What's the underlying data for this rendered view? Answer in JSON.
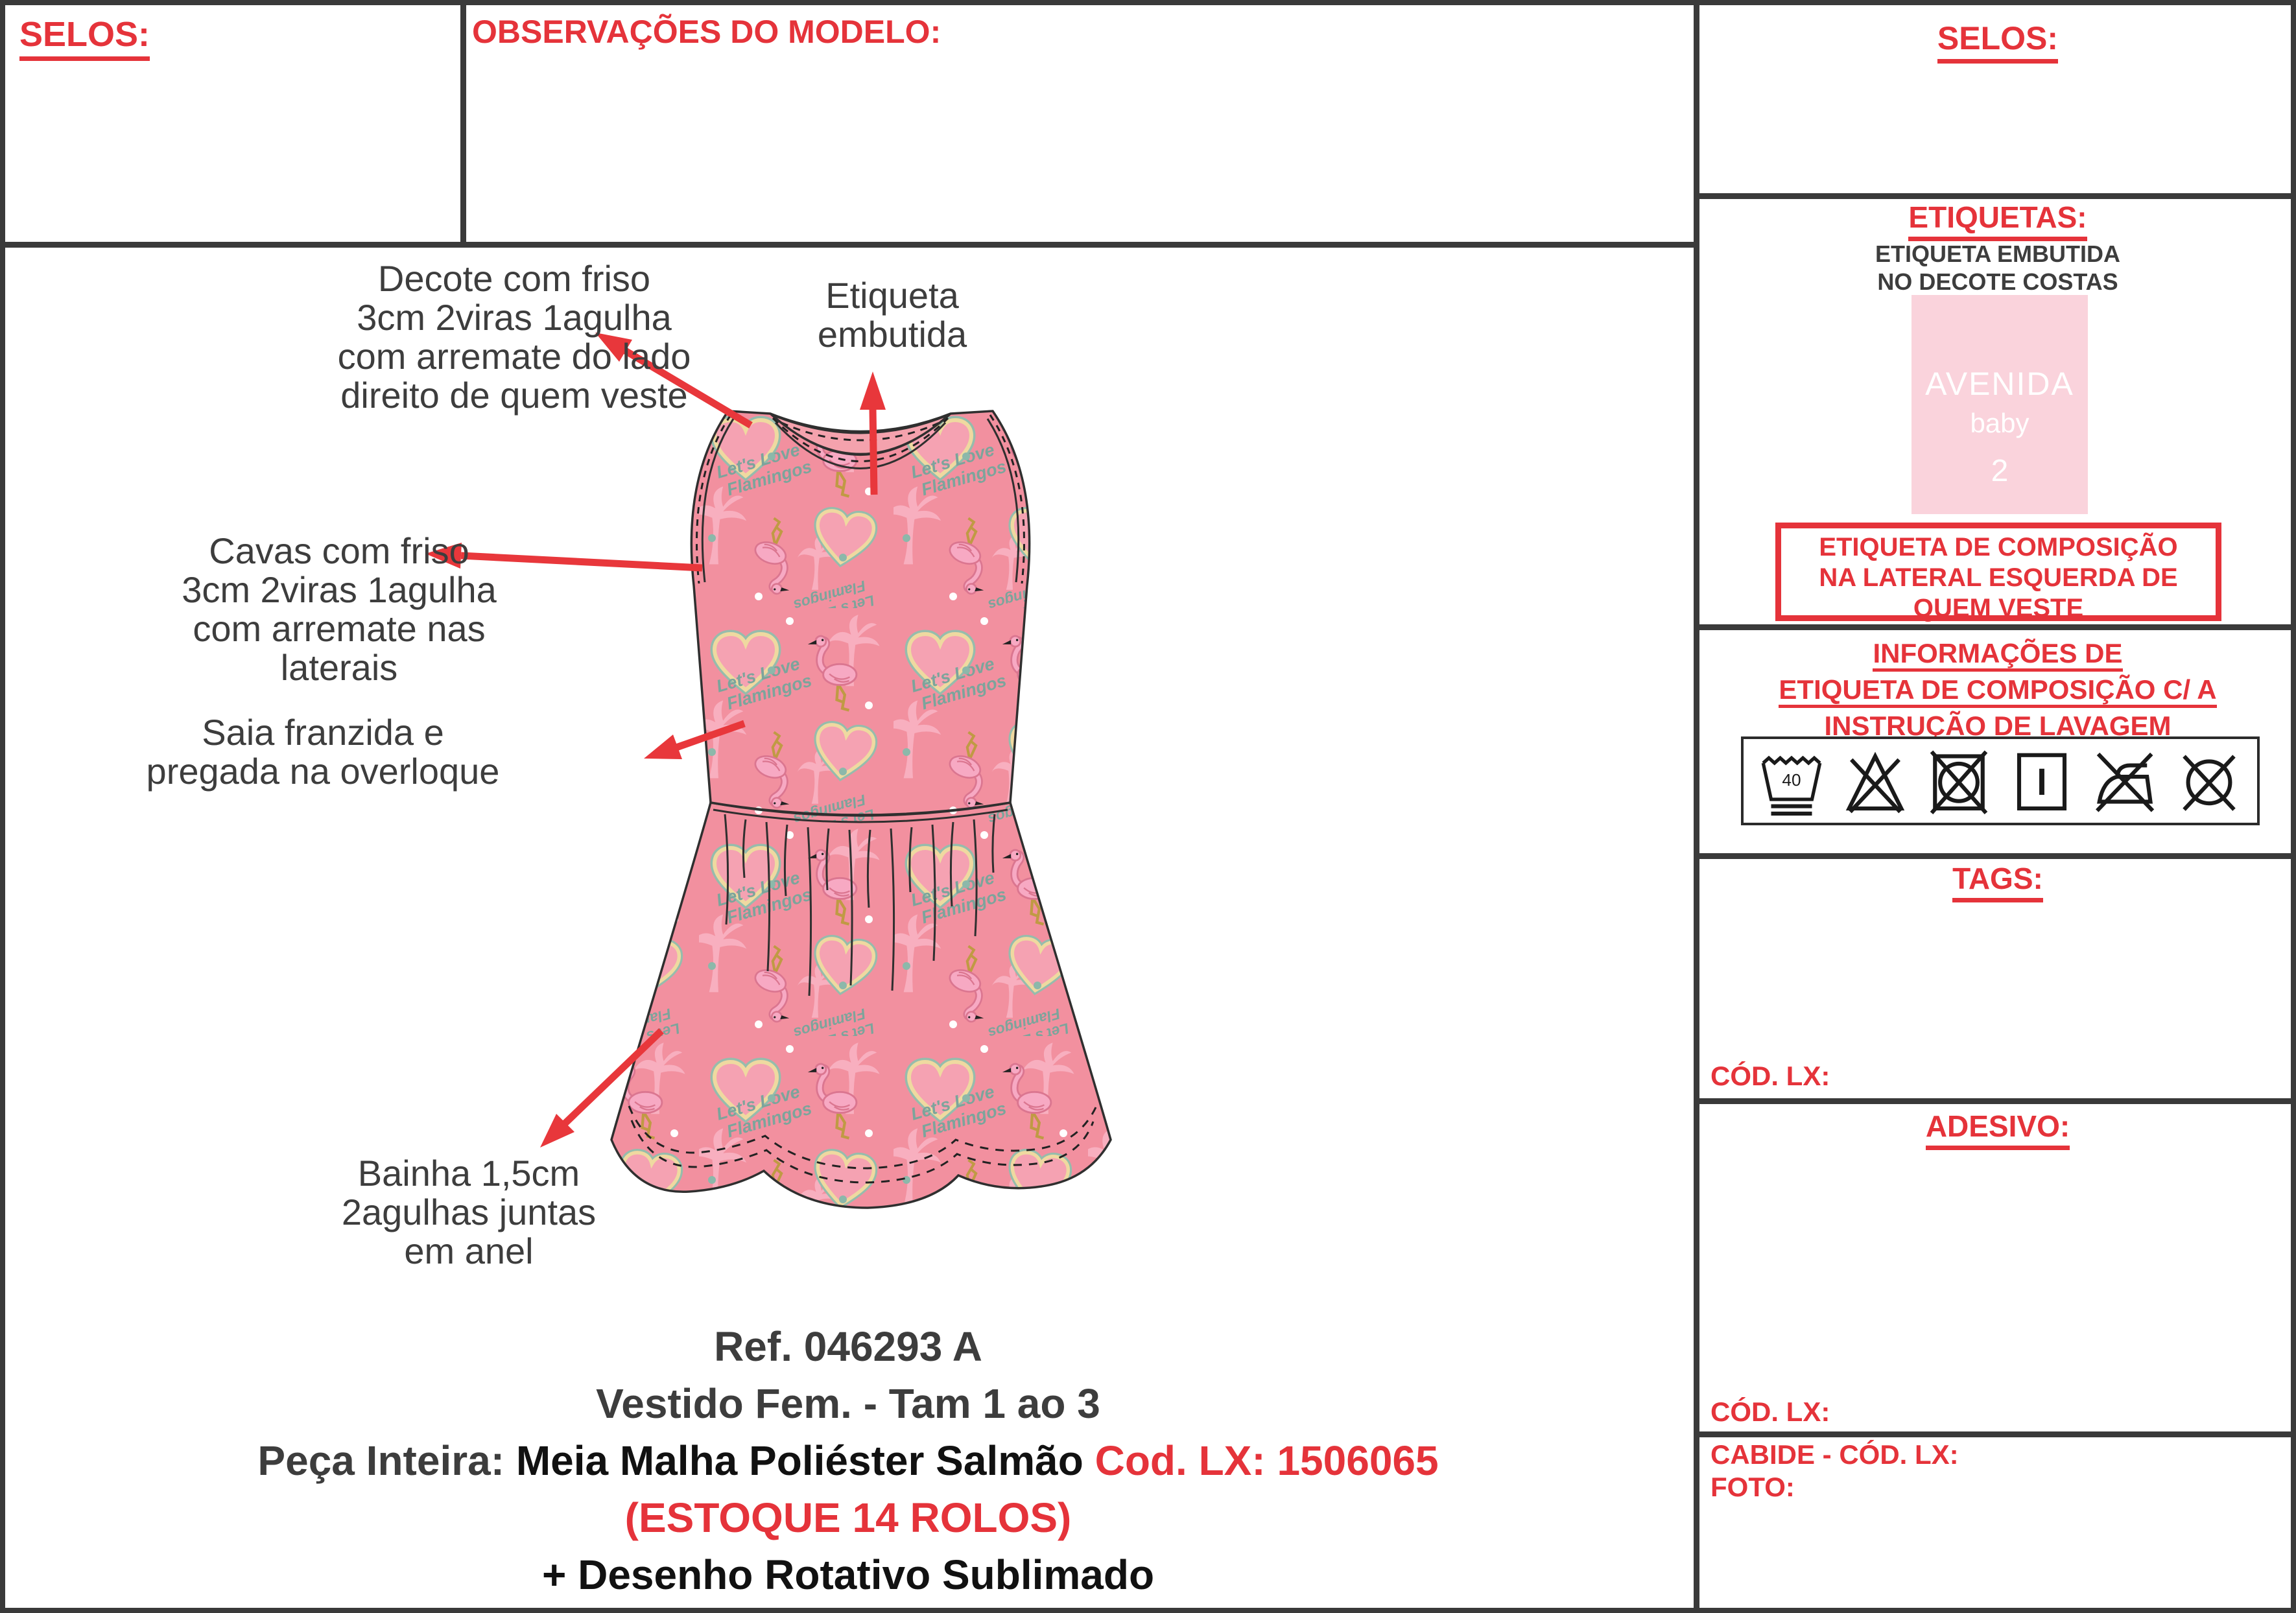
{
  "colors": {
    "accent_red": "#e5333a",
    "text_dark": "#3d3d3d",
    "text_black": "#111111",
    "border": "#3a3a3a",
    "dress_base": "#f2909f",
    "swatch_pink": "#fad3dc"
  },
  "top": {
    "selos_title": "SELOS:",
    "observations_title": "OBSERVAÇÕES DO MODELO:"
  },
  "annotations": {
    "decote": {
      "lines": [
        "Decote com friso",
        "3cm 2viras 1agulha",
        "com arremate do lado",
        "direito de quem veste"
      ]
    },
    "etiqueta": {
      "lines": [
        "Etiqueta",
        "embutida"
      ]
    },
    "cavas": {
      "lines": [
        "Cavas com friso",
        "3cm 2viras 1agulha",
        "com arremate nas",
        "laterais"
      ]
    },
    "saia": {
      "lines": [
        "Saia franzida e",
        "pregada na overloque"
      ]
    },
    "bainha": {
      "lines": [
        "Bainha 1,5cm",
        "2agulhas juntas",
        "em anel"
      ]
    }
  },
  "pattern": {
    "script_line1": "Let's Love",
    "script_line2": "Flamingos"
  },
  "product": {
    "ref": "Ref. 046293 A",
    "name_size": "Vestido Fem.  - Tam 1 ao 3",
    "fabric_label": "Peça Inteira: ",
    "fabric": "Meia Malha Poliéster Salmão ",
    "fabric_code": "Cod. LX: 1506065",
    "stock": "(ESTOQUE 14 ROLOS)",
    "print": "+ Desenho Rotativo Sublimado"
  },
  "right": {
    "selos_title": "SELOS:",
    "etiquetas": {
      "title": "ETIQUETAS:",
      "note_line1": "ETIQUETA EMBUTIDA",
      "note_line2": "NO DECOTE COSTAS",
      "label_swatch": {
        "brand": "AVENIDA",
        "sub": "baby",
        "size": "2"
      },
      "warning_lines": [
        "ETIQUETA DE COMPOSIÇÃO",
        "NA LATERAL ESQUERDA DE",
        "QUEM VESTE"
      ]
    },
    "care": {
      "title_lines": [
        "INFORMAÇÕES DE",
        "ETIQUETA DE COMPOSIÇÃO C/ A",
        "INSTRUÇÃO DE LAVAGEM"
      ],
      "wash_temp": "40",
      "symbols": [
        "wash-40",
        "do-not-bleach",
        "do-not-tumble-dry",
        "line-dry",
        "do-not-iron",
        "do-not-dry-clean"
      ]
    },
    "tags": {
      "title": "TAGS:",
      "cod_lx_label": "CÓD. LX:"
    },
    "adesivo": {
      "title": "ADESIVO:",
      "cod_lx_label": "CÓD. LX:"
    },
    "cabide": {
      "cabide_label": "CABIDE - CÓD. LX:",
      "foto_label": "FOTO:"
    }
  }
}
